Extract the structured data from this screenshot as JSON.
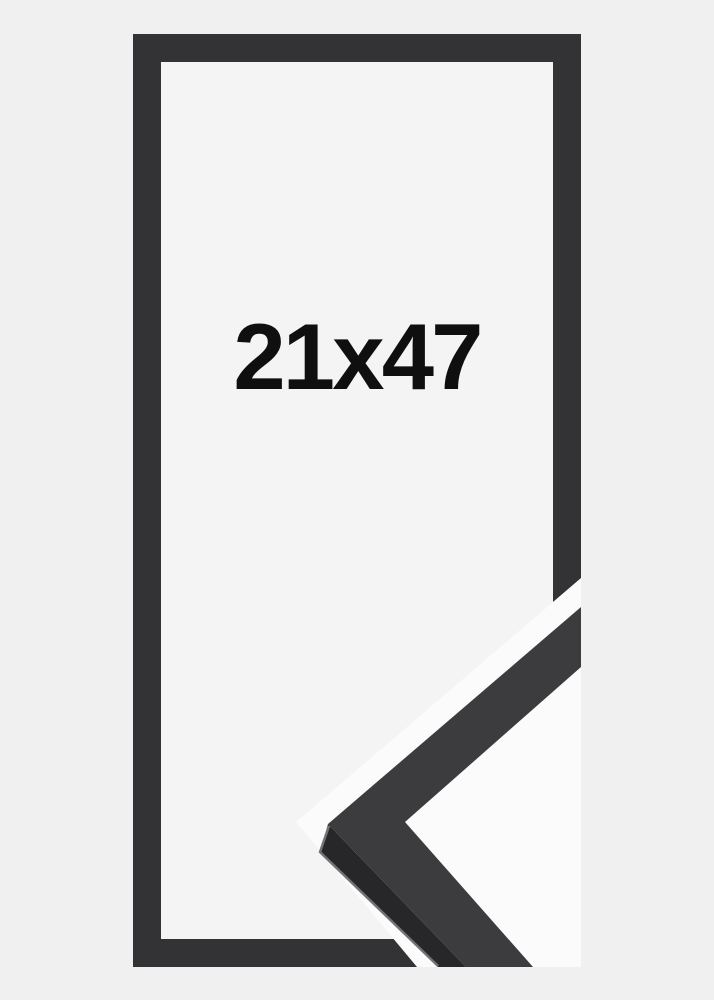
{
  "product": {
    "size_label": "21x47"
  },
  "image": {
    "description_parts": {
      "frame": "black picture frame front view",
      "corner_sample": "diagonal close-up of frame moulding corner profile"
    }
  },
  "colors": {
    "page_bg": "#f0f0f1",
    "opening_bg": "#f4f4f5",
    "sample_bg": "#fbfbfc",
    "frame": "#333336",
    "sample_top_face": "#3c3c3e",
    "sample_top_edge": "#2a2a2c",
    "sample_side_face": "#27272a",
    "sample_highlight": "#737377",
    "label_text": "#0f0f0f"
  }
}
